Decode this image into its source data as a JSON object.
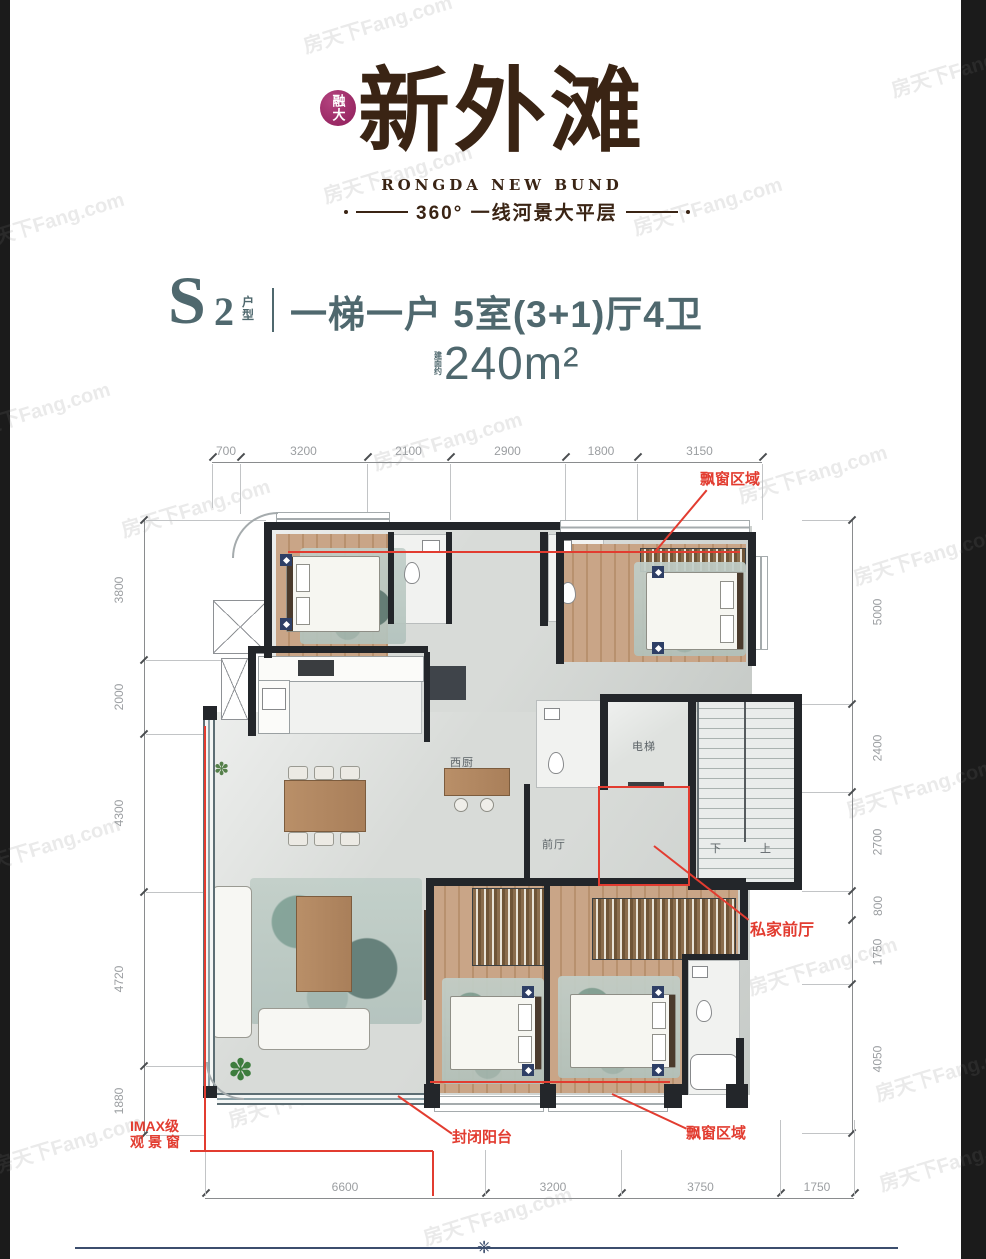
{
  "brand": {
    "seal": "融大",
    "title": "新外滩",
    "subtitle": "RONGDA NEW BUND",
    "tagline": "360° 一线河景大平层"
  },
  "unit": {
    "code": "S",
    "code_num": "2",
    "code_label_1": "户",
    "code_label_2": "型",
    "headline": "一梯一户 5室(3+1)厅4卫",
    "area_prefix_1": "建",
    "area_prefix_2": "面",
    "area_prefix_3": "约",
    "area": "240m²"
  },
  "dimensions": {
    "top": [
      "700",
      "3200",
      "2100",
      "2900",
      "1800",
      "3150"
    ],
    "left": [
      "3800",
      "2000",
      "4300",
      "4720",
      "1880"
    ],
    "right": [
      "5000",
      "2400",
      "2700",
      "800",
      "1750",
      "4050"
    ],
    "bottom": [
      "6600",
      "3200",
      "3750",
      "1750"
    ]
  },
  "annotations": {
    "bay_window_top": "飘窗区域",
    "private_foyer": "私家前厅",
    "imax_line1": "IMAX级",
    "imax_line2": "观景窗",
    "enclosed_balcony": "封闭阳台",
    "bay_window_bottom": "飘窗区域"
  },
  "rooms": {
    "west_kitchen": "西厨",
    "elevator": "电梯",
    "foyer": "前厅",
    "stair_down": "下",
    "stair_up": "上"
  },
  "icons": {
    "plant": "✽",
    "ornament": "❈"
  },
  "watermark": "房天下Fang.com",
  "colors": {
    "accent_red": "#e23c30",
    "title_teal": "#4f686e",
    "logo_brown": "#3a2414",
    "seal_magenta": "#8e1d59",
    "divider_navy": "#3c4e6e",
    "wall_black": "#23262a"
  }
}
